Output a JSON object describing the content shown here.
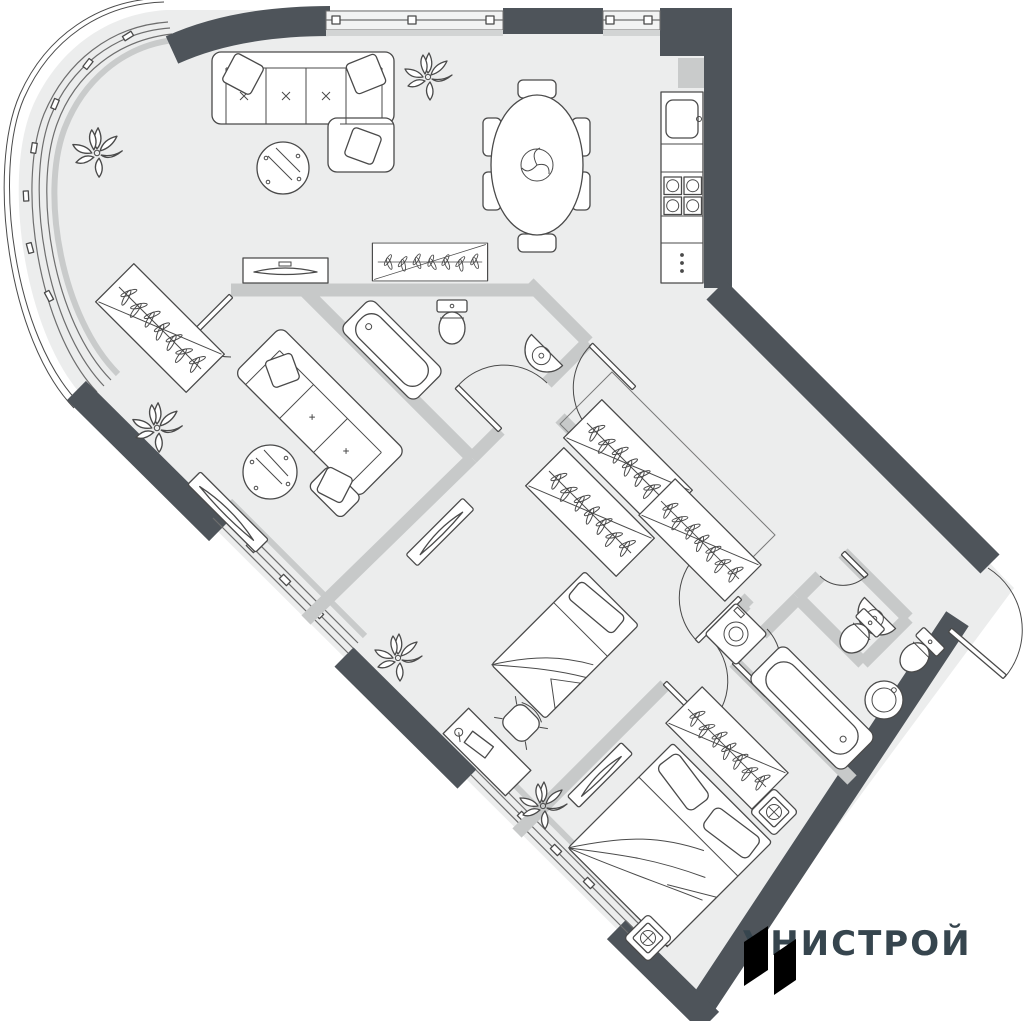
{
  "logo": {
    "text": "УНИСТРОЙ",
    "mark_color": "#76DB02",
    "text_color": "#36454E"
  },
  "colors": {
    "background": "#FFFFFF",
    "floor": "#ECEDED",
    "exterior_wall": "#4E545A",
    "partition_wall": "#C7C9C9",
    "furniture_outline": "#4A4A4A",
    "sill": "#C9CBCB"
  },
  "plan": {
    "type": "apartment-floor-plan",
    "fixtures": [
      "curved-glass-facade",
      "window",
      "l-shaped-sofa",
      "coffee-table",
      "plant",
      "dining-table",
      "dining-chair",
      "kitchen-sink",
      "kitchen-stove",
      "kitchen-fridge",
      "tv-console",
      "coat-rack",
      "wardrobe-hangers",
      "sofa",
      "side-table",
      "tv",
      "bathtub",
      "toilet",
      "corner-sink",
      "round-sink",
      "washing-machine",
      "single-bed",
      "desk",
      "desk-chair",
      "double-bed",
      "nightstand-lamp",
      "interior-door",
      "entrance-door",
      "dressing-area"
    ]
  }
}
